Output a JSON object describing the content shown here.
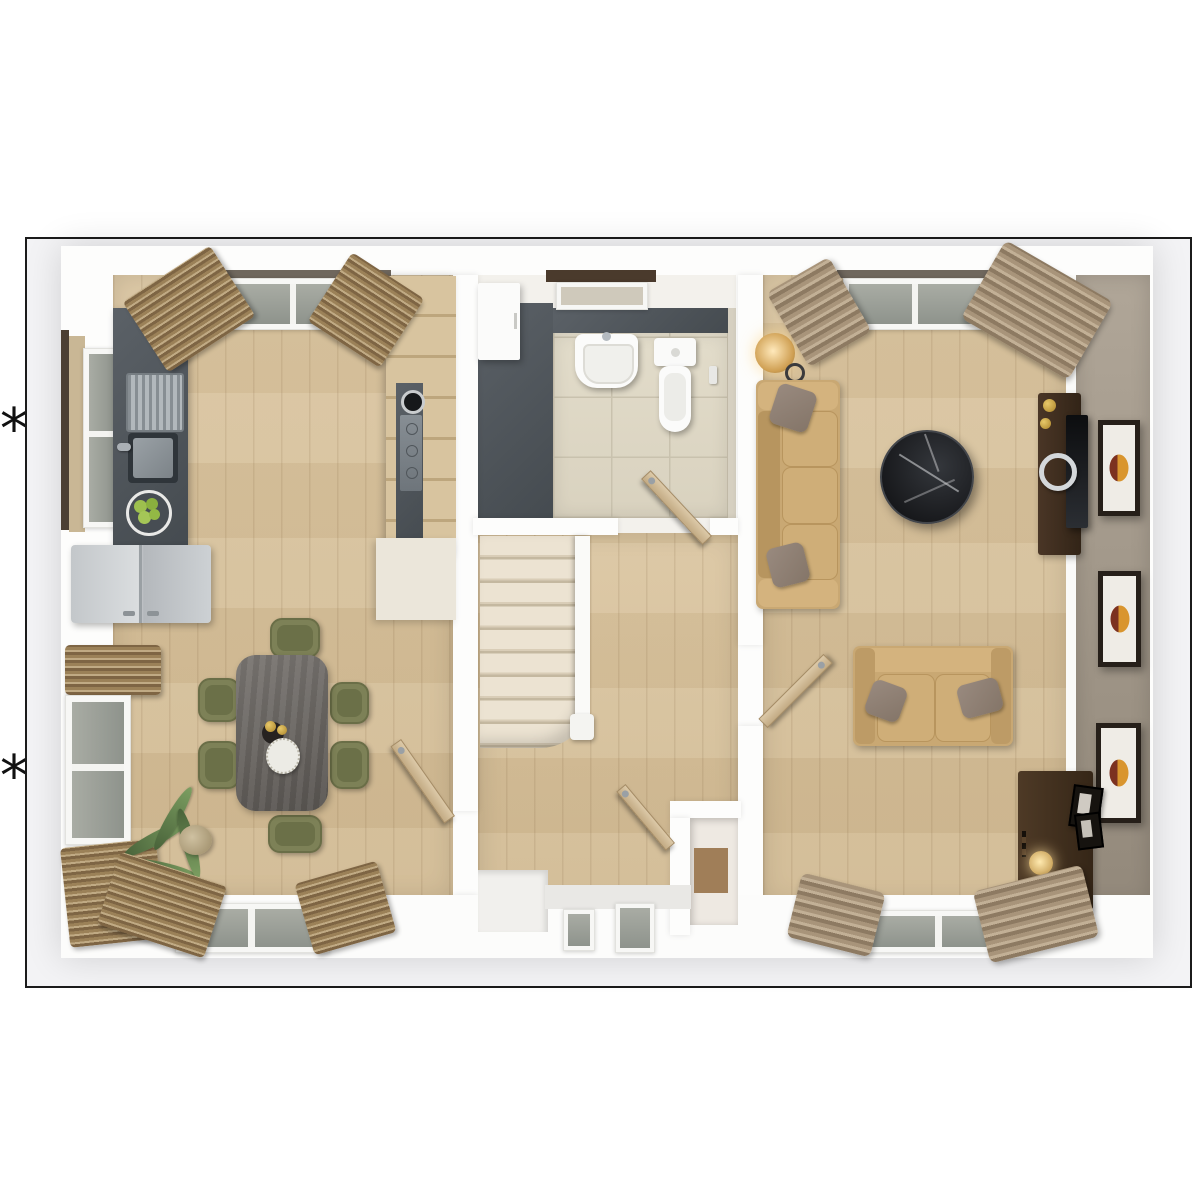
{
  "annotations": {
    "footnote_marker_top": "*",
    "footnote_marker_bottom": "*"
  },
  "floorplan": {
    "kind": "3d-top-down-ground-floor-plan-render",
    "frame": {
      "border_color": "#1b1b1b",
      "background": "#f3f3f5"
    },
    "rooms": [
      {
        "name": "kitchen-dining-room",
        "floor": "light-oak-planks",
        "furniture": [
          "worktop-with-sink",
          "fruit-bowl",
          "fridge-freezer",
          "tall-cabinets",
          "induction-hob",
          "dining-table",
          "six-green-chairs",
          "wine-bottles",
          "decorative-plate",
          "potted-palm-plant",
          "window-left-wall",
          "window-left-wall-lower",
          "window-bottom-wall",
          "window-top-wall",
          "wood-venetian-blinds"
        ]
      },
      {
        "name": "hallway",
        "floor": "light-oak-planks",
        "furniture": [
          "staircase-with-balustrade",
          "front-door-glazed",
          "understairs-closet",
          "open-door-to-kitchen",
          "open-door-to-living-room",
          "open-closet-door"
        ]
      },
      {
        "name": "wc-cloakroom",
        "floor": "beige-ceramic-tiles",
        "furniture": [
          "wall-hung-basin",
          "toilet",
          "white-cabinet",
          "slate-feature-floor",
          "small-window",
          "door-handle"
        ]
      },
      {
        "name": "living-room",
        "floor": "light-oak-planks",
        "furniture": [
          "three-seat-sofa",
          "two-seat-sofa",
          "throw-pillows",
          "round-marble-coffee-table",
          "tv-media-unit",
          "floor-lamp",
          "desk-with-lamp",
          "three-wall-art-frames",
          "window-top-wall",
          "window-bottom-wall",
          "curtains"
        ]
      }
    ],
    "palette": {
      "oak_floor": "#d6c09b",
      "slate_counter": "#4e545a",
      "tile_floor": "#ded8c6",
      "taupe_wall": "#a0968a",
      "sofa_tan": "#c9a873",
      "chair_olive": "#7d8157",
      "table_gray_wood": "#6e6a64",
      "marble_black": "#1f2226",
      "art_orange": "#d9952e",
      "art_maroon": "#7c3120",
      "door_oak": "#d0b98f",
      "stair_carpet": "#e9e0cf"
    }
  }
}
